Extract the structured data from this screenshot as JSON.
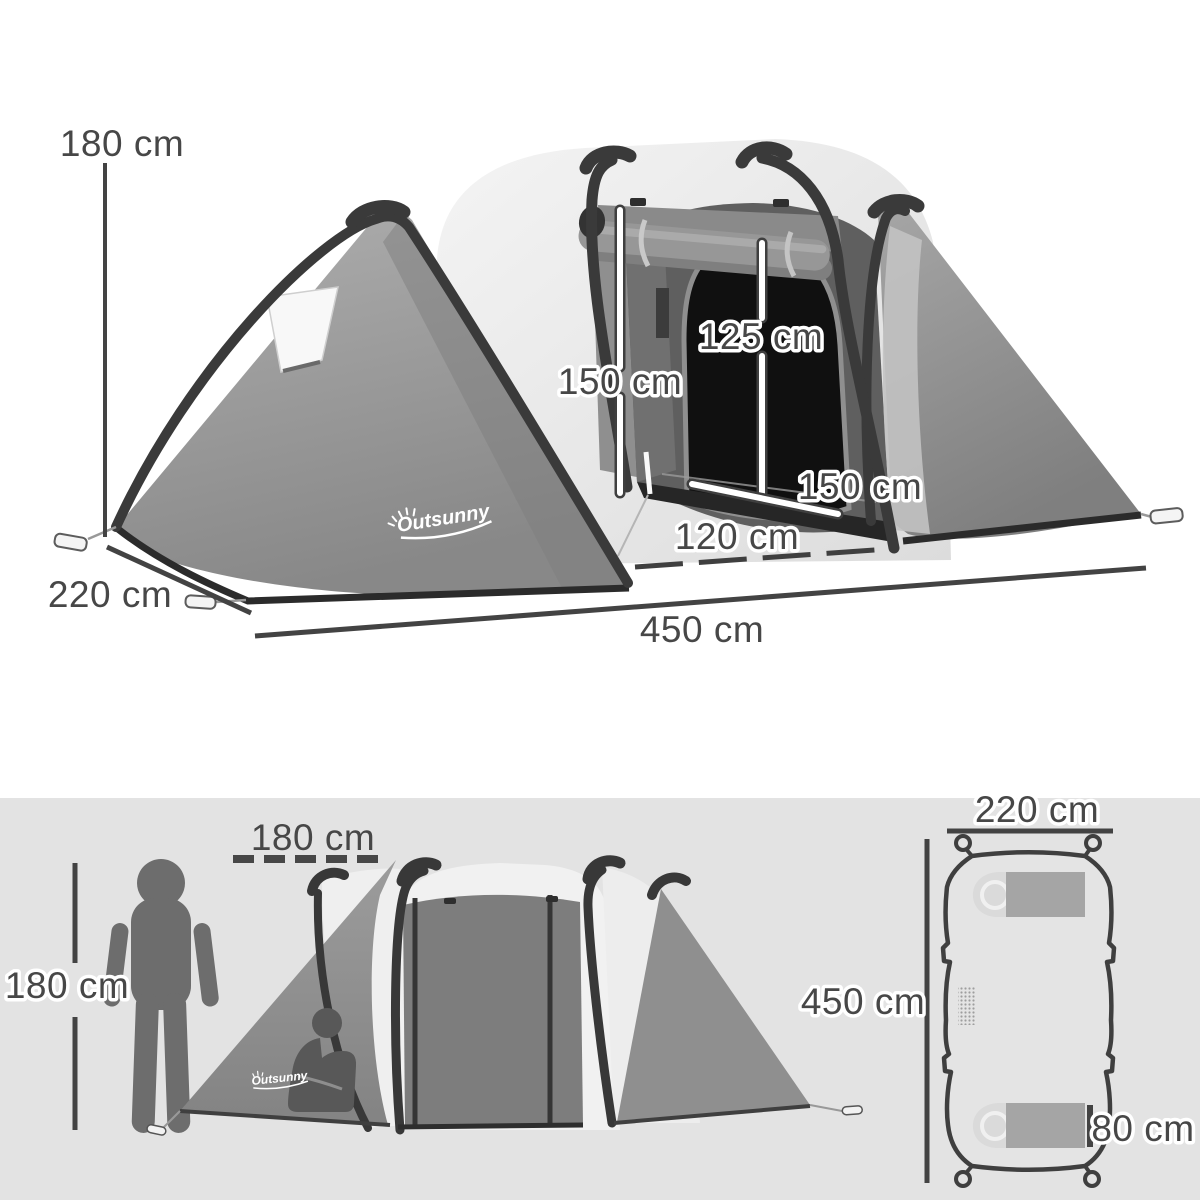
{
  "brand": {
    "logo_text": "Outsunny"
  },
  "perspective_view": {
    "total_height": "180 cm",
    "depth": "220 cm",
    "total_width": "450 cm",
    "inner_height": "150 cm",
    "inner_door_height": "125 cm",
    "inner_room_width": "150 cm",
    "door_width": "120 cm"
  },
  "side_view": {
    "person_height": "180 cm",
    "porch_length": "180 cm"
  },
  "floor_plan": {
    "width": "220 cm",
    "length": "450 cm",
    "sleeping_bag_width": "80 cm"
  },
  "colors": {
    "top_background": "#ffffff",
    "bottom_background": "#e3e3e3",
    "fabric_gray": "#949494",
    "fabric_light_gray": "#eeeeee",
    "pole_dark": "#3a3a3a",
    "dimension_text": "#474747",
    "silhouette": "#6d6d6d",
    "logo_white": "#ffffff"
  }
}
